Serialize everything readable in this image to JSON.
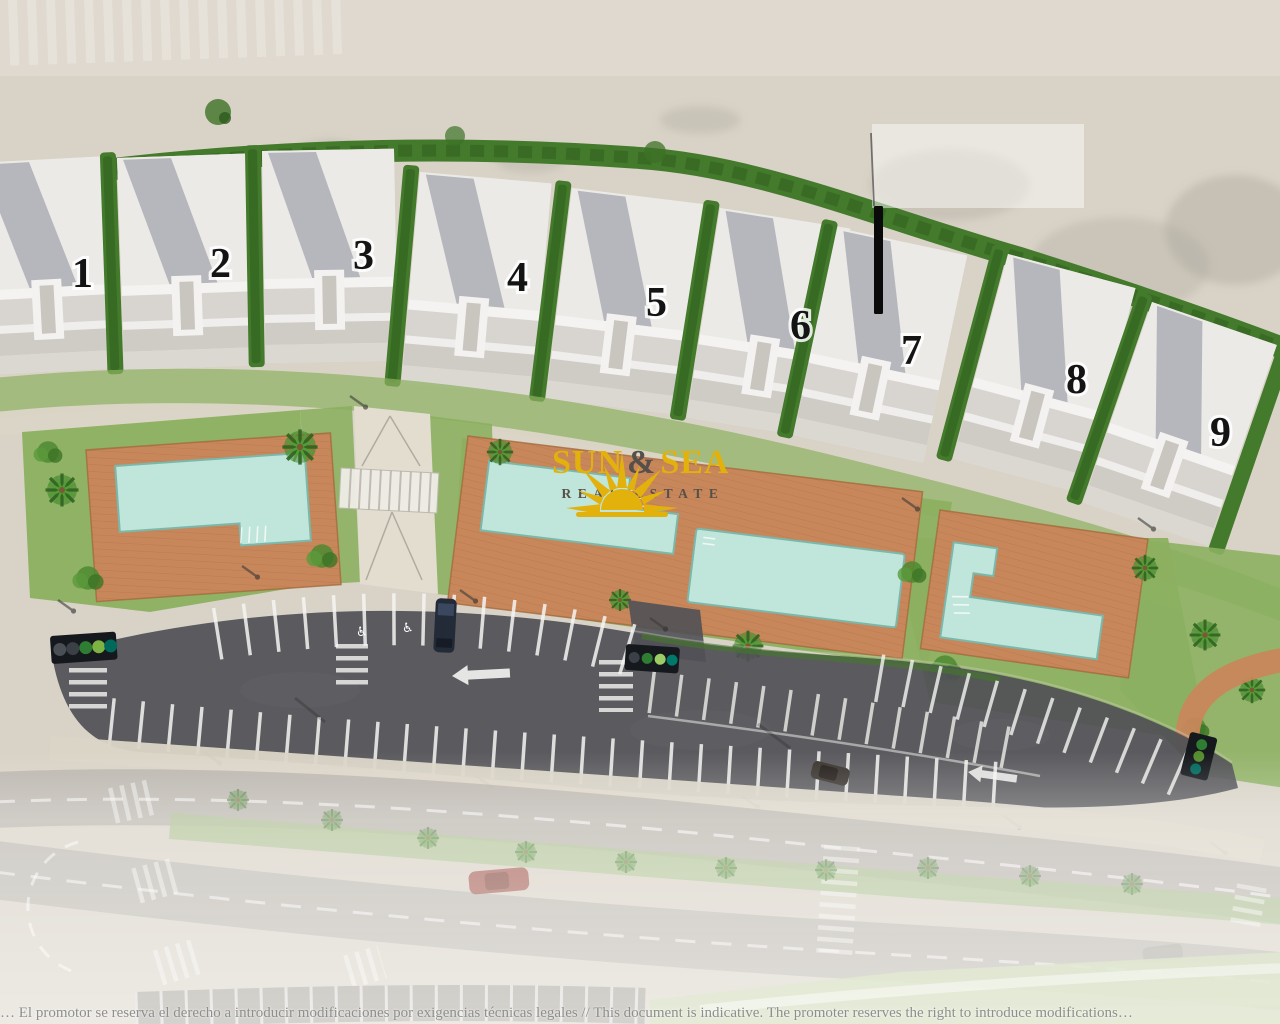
{
  "plan": {
    "buildings": [
      {
        "label": "1"
      },
      {
        "label": "2"
      },
      {
        "label": "3"
      },
      {
        "label": "4"
      },
      {
        "label": "5"
      },
      {
        "label": "6"
      },
      {
        "label": "7"
      },
      {
        "label": "8"
      },
      {
        "label": "9"
      }
    ],
    "logo": {
      "word1": "SUN",
      "ampersand": "&",
      "word2": "SEA",
      "subtitle": "REAL ESTATE"
    },
    "footer": {
      "disclaimer": "… El promotor se reserva el derecho a introducir modificaciones por exigencias técnicas legales // This document is indicative. The promoter reserves the right to introduce modifications…"
    },
    "icons": {
      "sun": "sun-rays-icon",
      "left_arrow": "left-arrow-road-marking",
      "wheelchair": "accessible-parking-marking",
      "palm": "palm-tree-icon"
    },
    "colors": {
      "sand": "#d9d3c7",
      "hedge": "#447a2c",
      "hedge_dark": "#2d5c1e",
      "lawn": "#8cb060",
      "deck": "#c8875b",
      "deck_edge": "#a46a3d",
      "pool": "#c0e5da",
      "pool_edge": "#7ab8ac",
      "asphalt": "#515156",
      "road": "#b7b3ab",
      "sidewalk": "#dbd5c7",
      "marking": "#f5f5f2",
      "logo_gold": "#e2b10c",
      "logo_dark": "#56504a",
      "number_ink": "#141414"
    }
  }
}
